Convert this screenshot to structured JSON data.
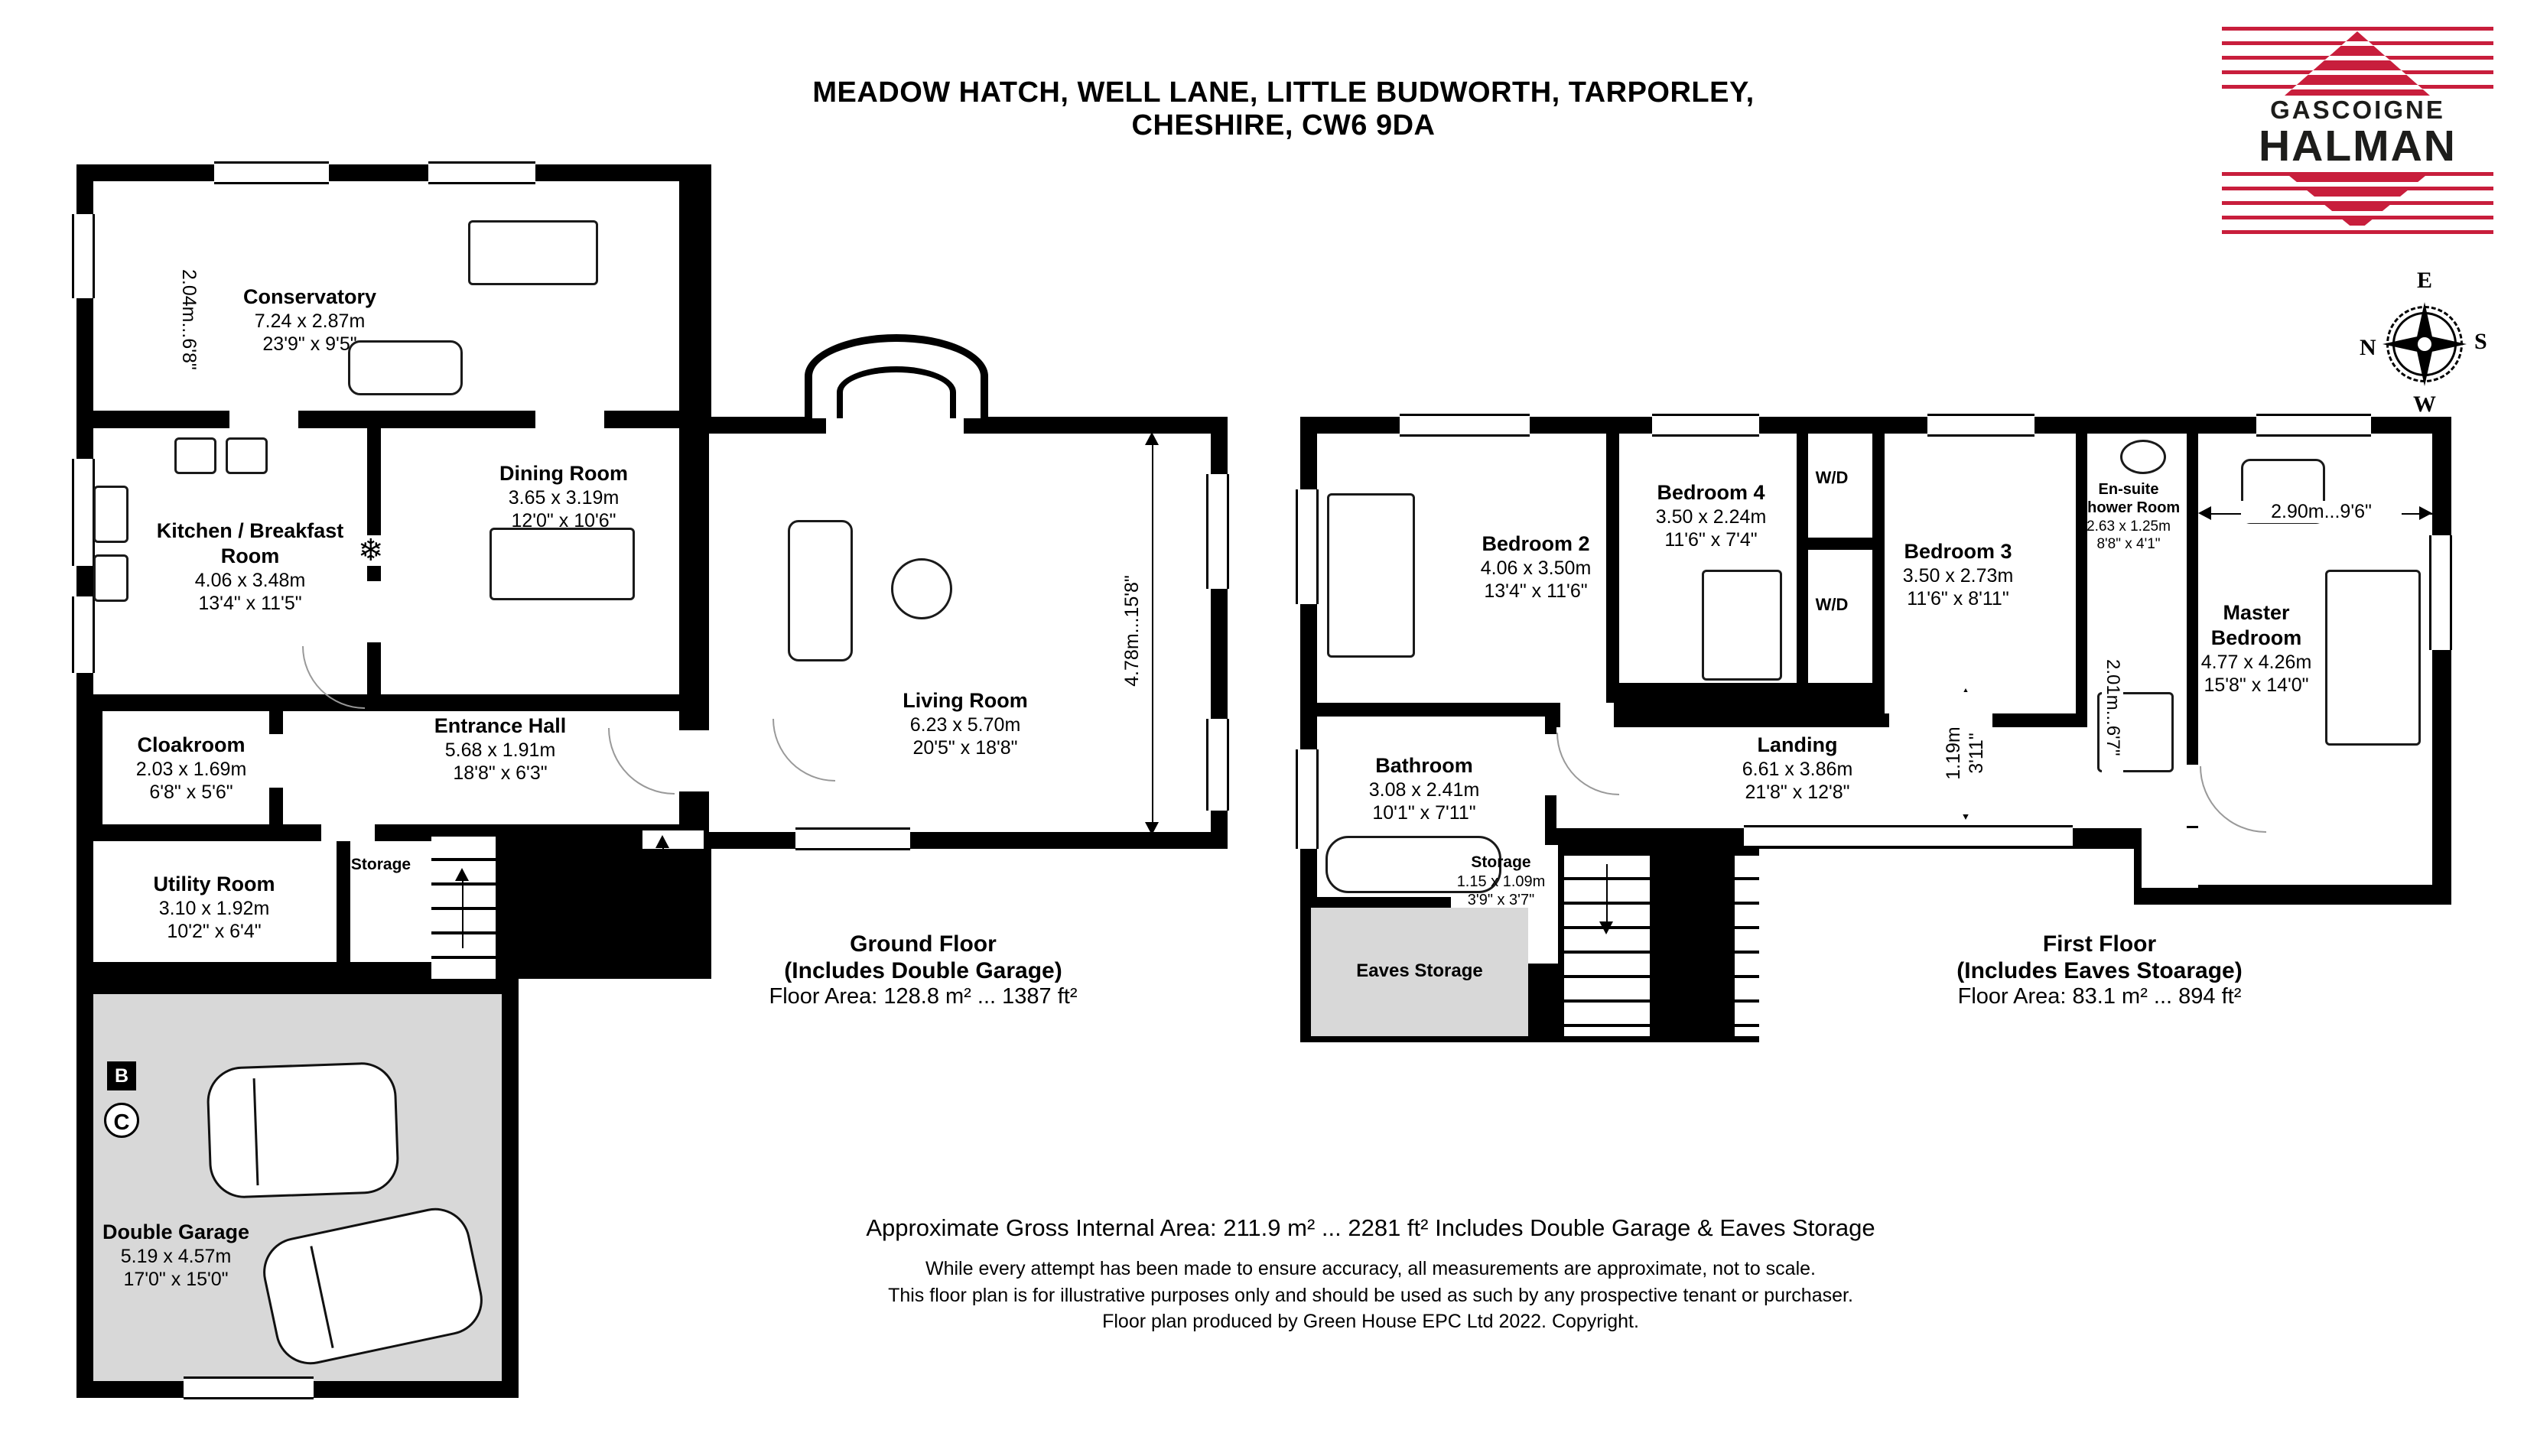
{
  "header": {
    "title": "MEADOW HATCH, WELL LANE, LITTLE BUDWORTH, TARPORLEY, CHESHIRE, CW6 9DA"
  },
  "logo": {
    "line1": "GASCOIGNE",
    "line2": "HALMAN",
    "red": "#c81e3c",
    "black": "#1d1d1b"
  },
  "compass": {
    "n": "N",
    "e": "E",
    "s": "S",
    "w": "W"
  },
  "ground_floor": {
    "summary": {
      "title": "Ground Floor",
      "subtitle": "(Includes Double Garage)",
      "area": "Floor Area: 128.8 m² ... 1387 ft²"
    },
    "rooms": [
      {
        "name": "Conservatory",
        "metric": "7.24 x 2.87m",
        "imperial": "23'9\" x 9'5\""
      },
      {
        "name": "Kitchen / Breakfast Room",
        "metric": "4.06 x 3.48m",
        "imperial": "13'4\" x 11'5\""
      },
      {
        "name": "Dining Room",
        "metric": "3.65 x 3.19m",
        "imperial": "12'0\" x 10'6\""
      },
      {
        "name": "Living Room",
        "metric": "6.23 x 5.70m",
        "imperial": "20'5\" x 18'8\""
      },
      {
        "name": "Entrance Hall",
        "metric": "5.68 x 1.91m",
        "imperial": "18'8\" x 6'3\""
      },
      {
        "name": "Cloakroom",
        "metric": "2.03 x 1.69m",
        "imperial": "6'8\" x 5'6\""
      },
      {
        "name": "Utility Room",
        "metric": "3.10 x 1.92m",
        "imperial": "10'2\" x 6'4\""
      },
      {
        "name": "Double Garage",
        "metric": "5.19 x 4.57m",
        "imperial": "17'0\" x 15'0\""
      }
    ],
    "storage_label": "Storage",
    "entrance_label": "Entrance",
    "dim_left": "2.04m...6'8\"",
    "dim_right": "4.78m...15'8\"",
    "marker_b": "B",
    "marker_c": "C"
  },
  "first_floor": {
    "summary": {
      "title": "First Floor",
      "subtitle": "(Includes Eaves Stoarage)",
      "area": "Floor Area: 83.1 m² ... 894 ft²"
    },
    "rooms": [
      {
        "name": "Bedroom 2",
        "metric": "4.06 x 3.50m",
        "imperial": "13'4\" x 11'6\""
      },
      {
        "name": "Bedroom 4",
        "metric": "3.50 x 2.24m",
        "imperial": "11'6\" x 7'4\""
      },
      {
        "name": "Bedroom 3",
        "metric": "3.50 x 2.73m",
        "imperial": "11'6\" x 8'11\""
      },
      {
        "name": "Master Bedroom",
        "metric": "4.77 x 4.26m",
        "imperial": "15'8\" x 14'0\""
      },
      {
        "name": "En-suite Shower Room",
        "metric": "2.63 x 1.25m",
        "imperial": "8'8\" x 4'1\""
      },
      {
        "name": "Bathroom",
        "metric": "3.08 x 2.41m",
        "imperial": "10'1\" x 7'11\""
      },
      {
        "name": "Landing",
        "metric": "6.61 x 3.86m",
        "imperial": "21'8\" x 12'8\""
      },
      {
        "name": "Storage",
        "metric": "1.15 x 1.09m",
        "imperial": "3'9\" x 3'7\""
      }
    ],
    "wd_label": "W/D",
    "eaves_label": "Eaves Storage",
    "dim_master": "2.90m...9'6\"",
    "dim_landing_m": "1.19m",
    "dim_landing_i": "3'11\"",
    "dim_ensuite": "2.01m...6'7\""
  },
  "footer": {
    "line1": "Approximate Gross Internal Area: 211.9 m² ... 2281 ft² Includes Double Garage & Eaves Storage",
    "line2": "While every attempt has been made to ensure accuracy, all measurements are approximate, not to scale.",
    "line3": "This floor plan is for illustrative purposes only and should be used as such by any prospective tenant or purchaser.",
    "line4": "Floor plan produced by Green House EPC Ltd 2022. Copyright."
  }
}
